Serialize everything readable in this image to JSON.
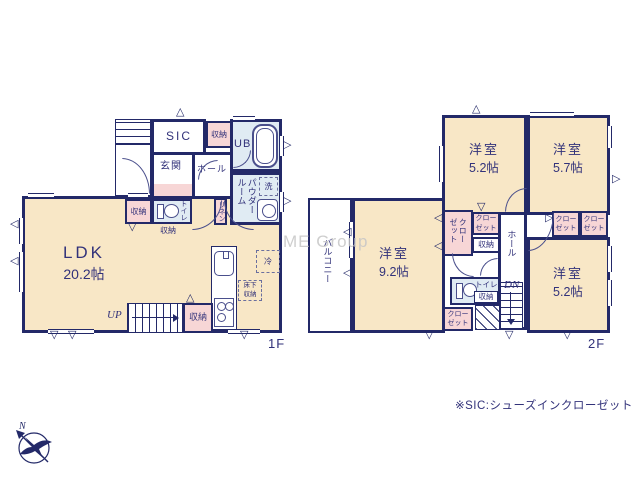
{
  "palette": {
    "wall": "#232968",
    "text": "#32327a",
    "room_cream": "#f8e7c6",
    "closet_pink": "#f7d6d6",
    "wet_blue": "#e0ebf3",
    "watermark_gray": "#c6c6c6"
  },
  "floor1": {
    "label": "1F",
    "ldk_name": "LDK",
    "ldk_size": "20.2帖",
    "sic": "SIC",
    "storage_top": "収納",
    "ub": "UB",
    "genkan": "玄関",
    "hall": "ホール",
    "powder_room": "パウダールーム",
    "washer": "洗",
    "storage_left": "収納",
    "toilet": "トイレ",
    "storage_under": "収納",
    "linen": "リネン",
    "fridge": "冷",
    "underfloor_storage": "床下収納",
    "up": "UP",
    "storage_bottom": "収納"
  },
  "floor2": {
    "label": "2F",
    "room_nw_name": "洋室",
    "room_nw_size": "5.2帖",
    "room_ne_name": "洋室",
    "room_ne_size": "5.7帖",
    "room_sw_name": "洋室",
    "room_sw_size": "9.2帖",
    "room_se_name": "洋室",
    "room_se_size": "5.2帖",
    "balcony": "バルコニー",
    "hall": "ホール",
    "closet_tall": "クローゼット",
    "closet_mid": "クローゼット",
    "storage_mid": "収納",
    "closet_ne1": "クローゼット",
    "closet_ne2": "クローゼット",
    "toilet": "トイレ",
    "storage_toilet": "収納",
    "closet_sw": "クローゼット",
    "dn": "DN"
  },
  "annotations": {
    "watermark": "ME Group",
    "note": "※SIC:シューズインクローゼット",
    "compass_north": "N"
  }
}
